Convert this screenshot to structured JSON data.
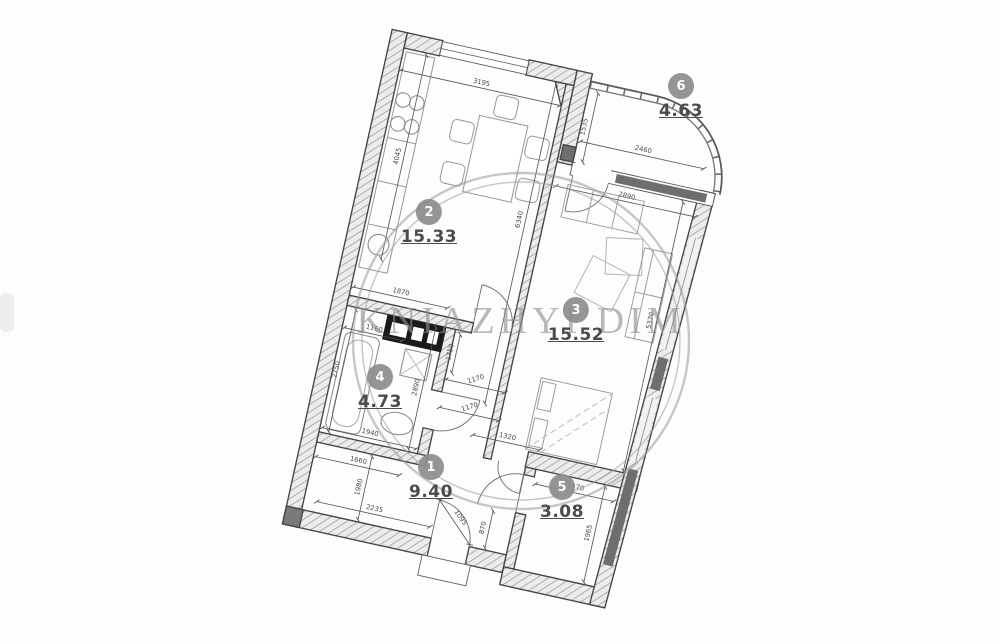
{
  "watermark": {
    "text": "KNIAZHYI DIM"
  },
  "rooms": [
    {
      "number": "1",
      "area": "9.40",
      "name": "hallway"
    },
    {
      "number": "2",
      "area": "15.33",
      "name": "kitchen"
    },
    {
      "number": "3",
      "area": "15.52",
      "name": "living-room"
    },
    {
      "number": "4",
      "area": "4.73",
      "name": "bathroom"
    },
    {
      "number": "5",
      "area": "3.08",
      "name": "storage"
    },
    {
      "number": "6",
      "area": "4.63",
      "name": "balcony"
    }
  ],
  "dims": {
    "kitchen_top": "3195",
    "balcony_left": "1535",
    "balcony_width": "2460",
    "living_top": "2890",
    "kitchen_left": "4045",
    "kitchen_depth": "6340",
    "living_right": "5370",
    "bath_top": "1870",
    "bath_inner": "1160",
    "bath_right": "2890",
    "bath_left": "2750",
    "bath_bottom": "1940",
    "below_bath": "1660",
    "hall_left": "1980",
    "hall_bottom": "2235",
    "hall_step": "870",
    "entrance_door": "1095",
    "corridor_a": "1170",
    "corridor_b": "1170",
    "corridor_top": "1750",
    "hall_room5": "1320",
    "room5_top": "1570",
    "room5_right": "1965"
  },
  "colors": {
    "wall_outline": "#454545",
    "hatch": "#9c9c9c",
    "dim_text": "#4a4a4a",
    "room_badge": "#8d8d8d",
    "area_text": "#4b4b4b",
    "watermark": "#8f8f8f",
    "window_panel": "#6e6e6e",
    "shaft": "#1a1a1a"
  }
}
